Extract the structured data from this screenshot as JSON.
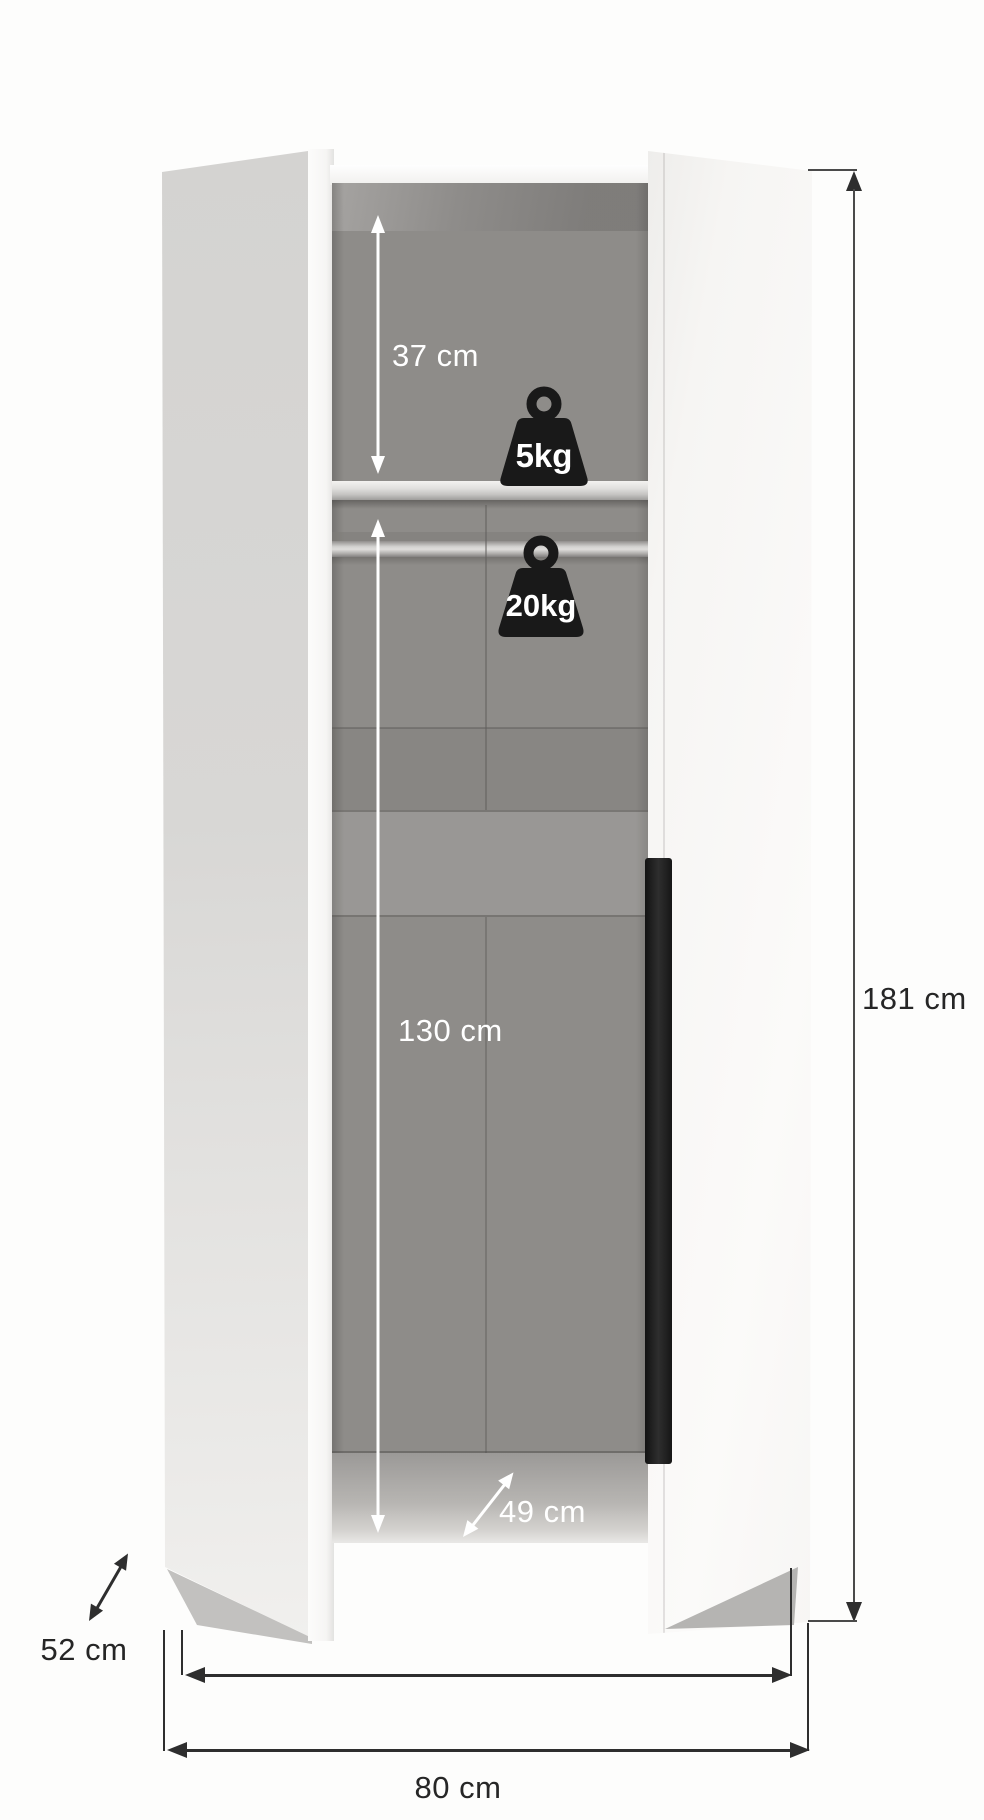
{
  "diagram": {
    "subject": "two-door wardrobe dimension diagram, doors open showing interior",
    "measurements": {
      "shelf_clearance": "37 cm",
      "shelf_load": "5kg",
      "rail_load": "20kg",
      "hanging_clearance": "130 cm",
      "interior_depth": "49 cm",
      "total_height": "181 cm",
      "total_depth": "52 cm",
      "interior_width": "75 cm",
      "total_width": "80 cm"
    },
    "icons": [
      "weight-icon-5kg",
      "weight-icon-20kg"
    ],
    "colors": {
      "background": "#fdfdfc",
      "interior_gray": "#8e8c89",
      "left_door": "#d8d7d5",
      "right_door": "#f8f7f5",
      "handle": "#1e1e1e",
      "weight_icon": "#191919",
      "dimension_line_dark": "#2e2e2e",
      "interior_annotation": "#ffffff"
    }
  }
}
